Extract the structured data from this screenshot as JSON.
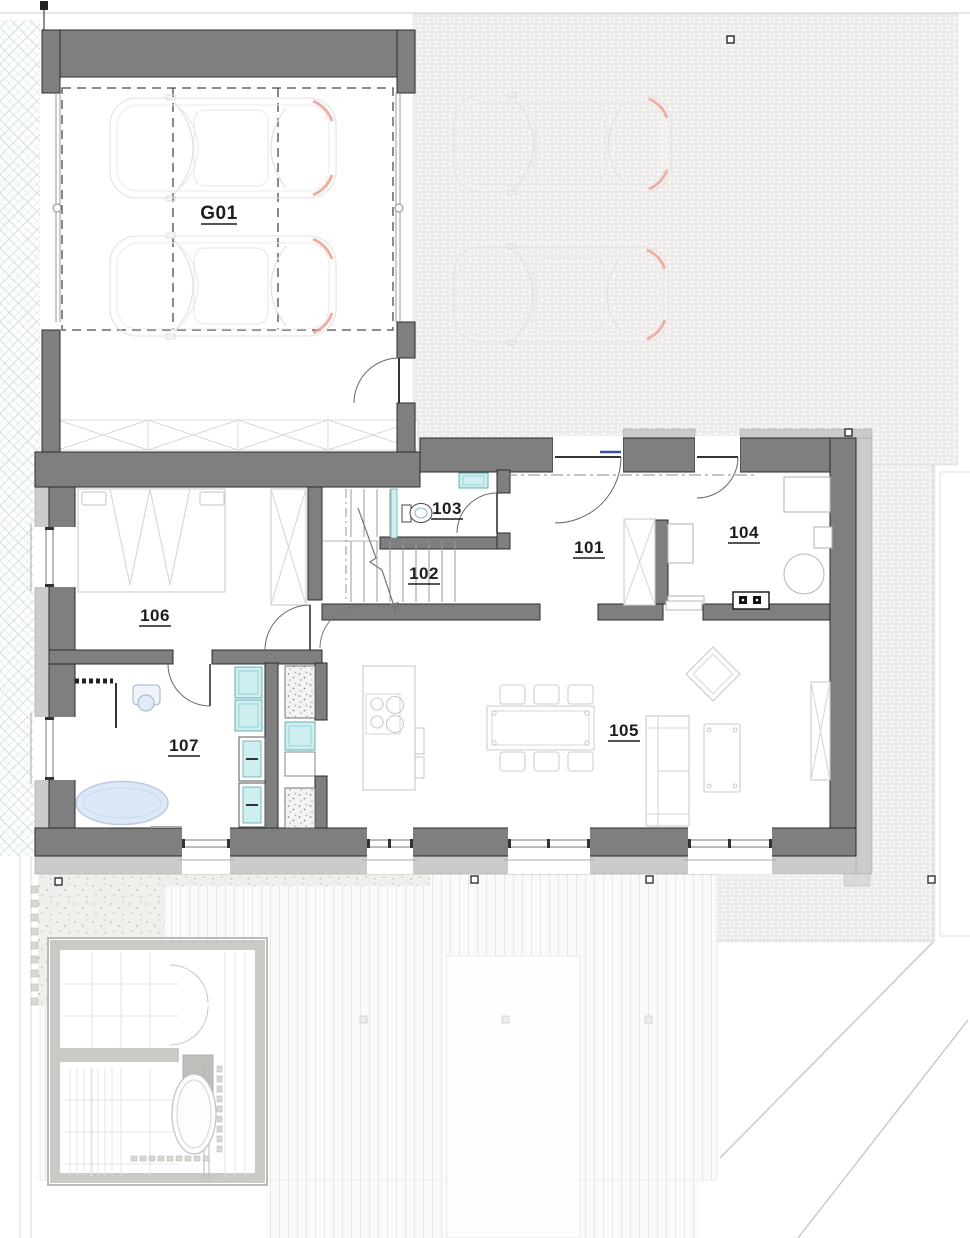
{
  "plan": {
    "rooms": {
      "garage": "G01",
      "hall": "101",
      "staircase": "102",
      "wc": "103",
      "office": "104",
      "living": "105",
      "bedroom": "106",
      "bathroom": "107"
    },
    "colors": {
      "wall_dark": "#7f7f7f",
      "wall_insulation": "#cbcbcb",
      "wall_outline": "#2b2b2b",
      "fixture_teal_fill": "#cfeef0",
      "fixture_teal_stroke": "#57a8b0",
      "bathtub_fill": "#dce8f7",
      "lawn_hatch_green": "#cfe3d8",
      "car_accent_red": "#eda092",
      "paving_line": "#e5e2df",
      "door_glazing_blue": "#3f51a5"
    }
  }
}
